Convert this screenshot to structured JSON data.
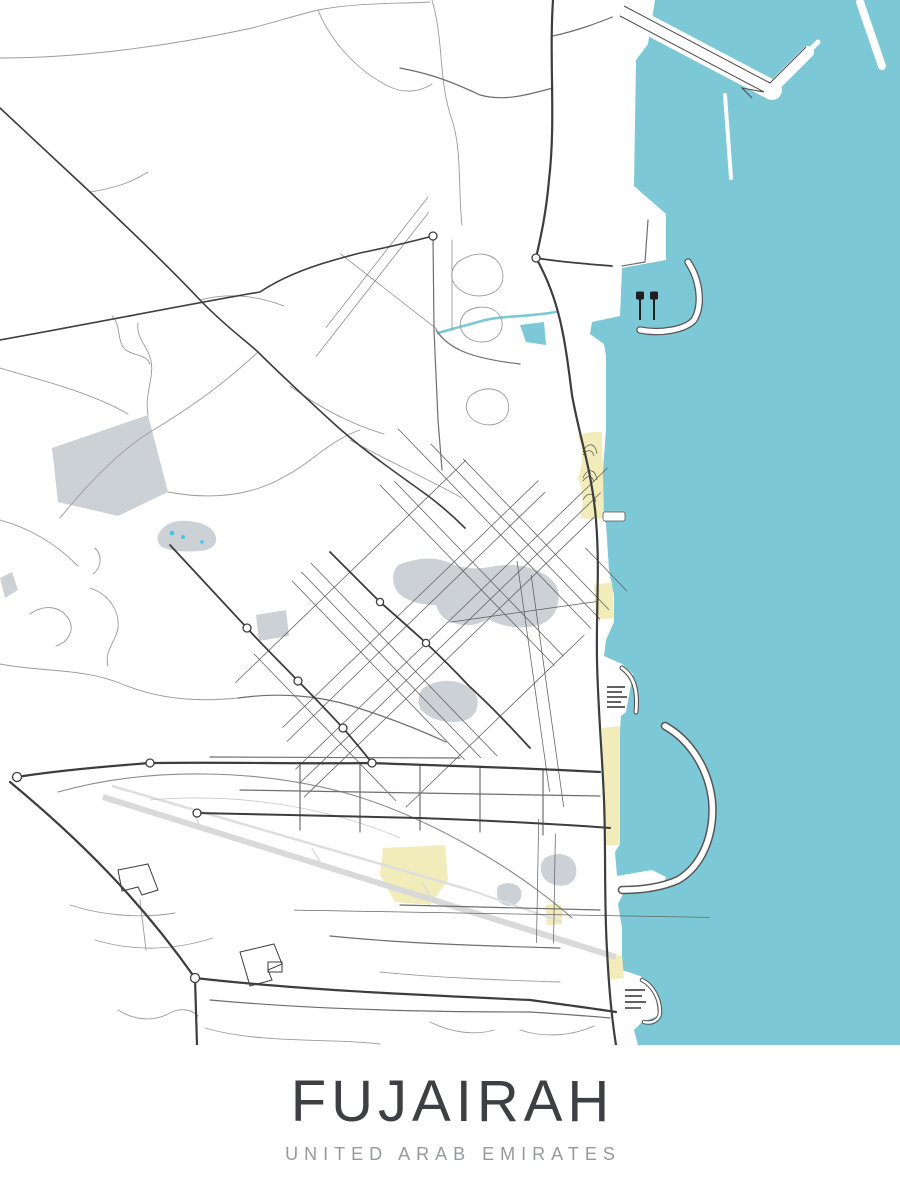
{
  "poster": {
    "title": "FUJAIRAH",
    "subtitle": "UNITED ARAB EMIRATES"
  },
  "palette": {
    "background": "#ffffff",
    "water": "#7cc8d6",
    "sand": "#f1ecb9",
    "park": "#ccd1d5",
    "pond_dots": "#47c2ec",
    "road_major": "#3d3d3d",
    "road_mid": "#6e6e6e",
    "road_minor": "#9b9b9b",
    "runway": "#d9d9d9",
    "title_color": "#3e3f43",
    "subtitle_color": "#97999c"
  },
  "features": {
    "sea": "sea-water",
    "port_north": "north-port-piers",
    "port_main": "main-harbor-breakwater",
    "marinas": "marina-piers",
    "beaches": "beach-sand-patches",
    "parks": "park-areas",
    "airport": "airport-runway",
    "streets": "street-network"
  }
}
